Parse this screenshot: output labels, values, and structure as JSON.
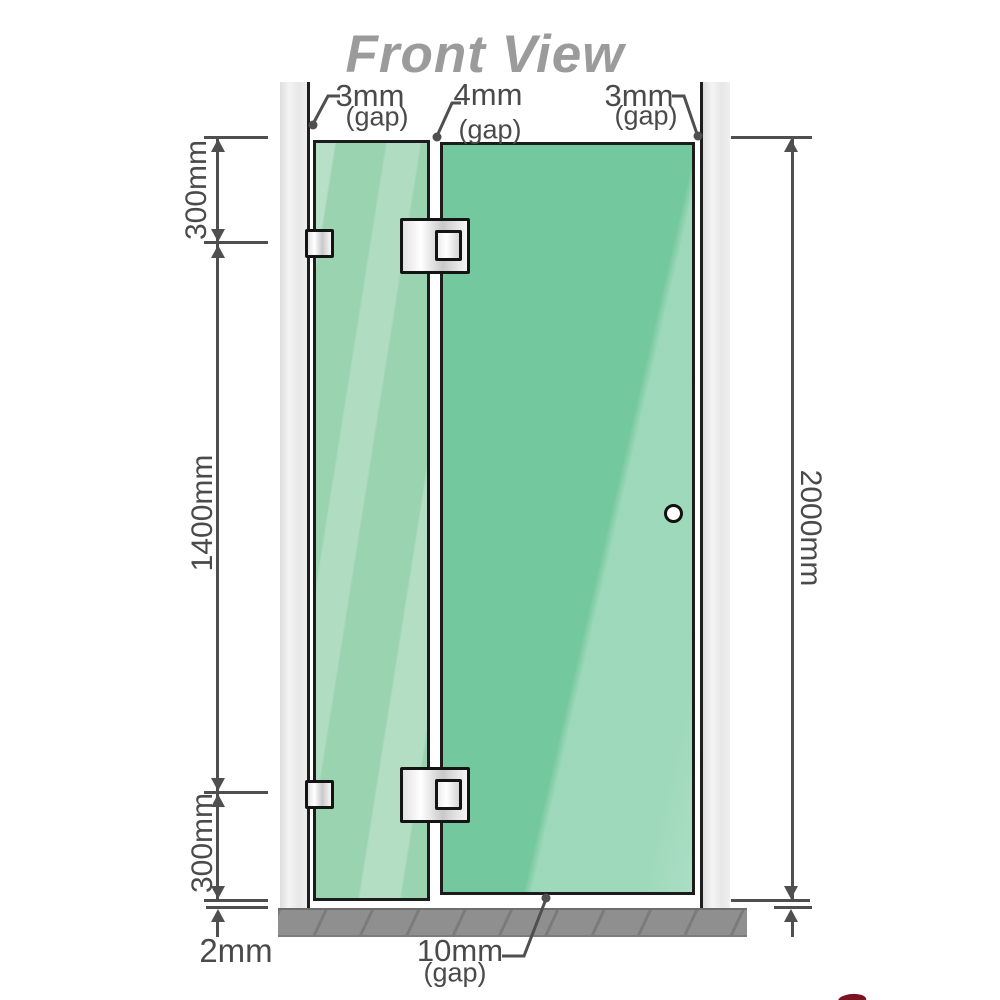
{
  "title": "Front View",
  "colors": {
    "title_text": "#9b9b9b",
    "dimension_lines": "#4f4f4f",
    "glass_fixed_panel": "#9ad3b0",
    "glass_door_panel": "#74c89d",
    "wall_channel": "#e9e9e9",
    "floor": "#8f8f8f",
    "hardware_fill": "#f2f2f2",
    "outline": "#1c1c1c",
    "logo_accent": "#7c1322"
  },
  "gap_labels": {
    "left": {
      "value": "3mm",
      "suffix": "(gap)"
    },
    "middle": {
      "value": "4mm",
      "suffix": "(gap)"
    },
    "right": {
      "value": "3mm",
      "suffix": "(gap)"
    },
    "bottom": {
      "value": "10mm",
      "suffix": "(gap)"
    }
  },
  "dimensions": {
    "panel_top_segment": "300mm",
    "panel_middle_segment": "1400mm",
    "panel_bottom_segment": "300mm",
    "overall_height": "2000mm",
    "floor_gap": "2mm"
  }
}
